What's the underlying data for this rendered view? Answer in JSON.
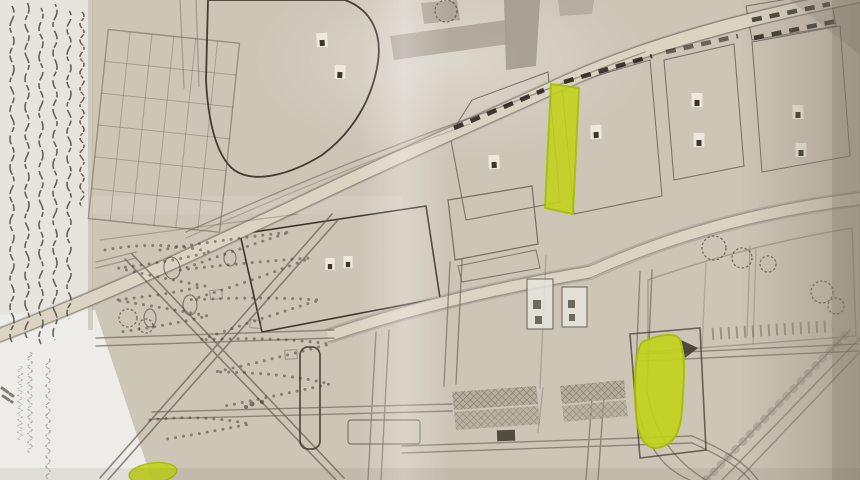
{
  "photo": {
    "description": "Photograph of a hand-drawn town plan map in pencil on aged beige paper, with handwritten margin notes, cross-hatched urban blocks, dashed boundary lines and yellow highlighter marks",
    "media": "pencil on folded paper, photographed",
    "visible_text_legible": false
  },
  "annotations": {
    "handwritten_notes": {
      "location": "left margin, vertical script",
      "legible": false,
      "line_count": 7
    },
    "highlights": [
      {
        "id": "highlight-strip-upper",
        "shape": "vertical strip between two hatched blocks"
      },
      {
        "id": "highlight-block-right",
        "shape": "small city block, right-centre"
      },
      {
        "id": "highlight-spot-bottom",
        "shape": "small spot at bottom-left street crossing"
      }
    ],
    "symbols": {
      "hatched_blocks": 9,
      "white_building_glyphs": 10,
      "dashed_boundary_segments": 5,
      "tree_scribbles": 8
    }
  },
  "colors": {
    "paper": "#cdc5b6",
    "paper_light": "#e7e4de",
    "margin_bottom": "#edece8",
    "road": "#dcd4c3",
    "road_shaded": "#a49c8f",
    "ink": "#6b6459",
    "ink_dark": "#3b362c",
    "hatch_fill": "#b1a998",
    "hatch_line": "#6f6858",
    "hatch_fill_dark": "#a09884",
    "hatch_line_dark": "#564f3e",
    "glyph_bg": "#efe9db",
    "highlight": "#c3d31a",
    "highlight_edge": "#a8bc00",
    "dash": "#221f19",
    "shadow": "#8d8274"
  }
}
